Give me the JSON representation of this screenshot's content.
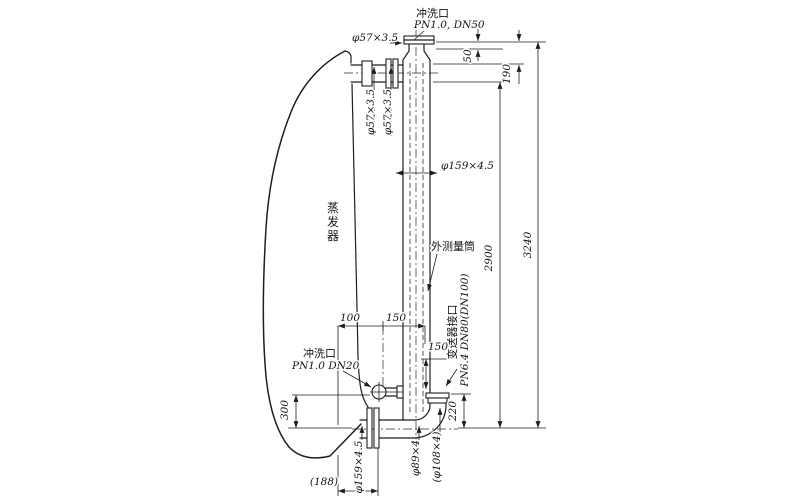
{
  "meta": {
    "background_color": "#ffffff",
    "ink_color": "#1e1e1e",
    "drawing_subject": "evaporator external level gauge piping"
  },
  "labels": [
    {
      "name": "top-flush-port-name",
      "text": "冲洗口",
      "x": 416,
      "y": 17,
      "cls": "cn",
      "anchor": "start"
    },
    {
      "name": "top-flush-port-spec",
      "text": "PN1.0, DN50",
      "x": 414,
      "y": 28,
      "cls": "spec",
      "anchor": "start"
    },
    {
      "name": "top-pipe-spec",
      "text": "φ57×3.5",
      "x": 352,
      "y": 41,
      "cls": "spec",
      "anchor": "start"
    },
    {
      "name": "riser-pipe-spec-1",
      "text": "φ57×3.5",
      "x": 374,
      "y": 112,
      "cls": "spec",
      "anchor": "middle",
      "rot": -90
    },
    {
      "name": "riser-pipe-spec-2",
      "text": "φ57×3.5",
      "x": 391,
      "y": 112,
      "cls": "spec",
      "anchor": "middle",
      "rot": -90
    },
    {
      "name": "cylinder-pipe-spec",
      "text": "φ159×4.5",
      "x": 441,
      "y": 169,
      "cls": "spec",
      "anchor": "start"
    },
    {
      "name": "evaporator-label",
      "text": "蒸发器",
      "x": 333,
      "y": 212,
      "cls": "cnv",
      "anchor": "middle"
    },
    {
      "name": "outer-cylinder-label",
      "text": "外测量筒",
      "x": 431,
      "y": 250,
      "cls": "cn",
      "anchor": "start"
    },
    {
      "name": "transmitter-port-name",
      "text": "变送器接口",
      "x": 456,
      "y": 332,
      "cls": "cn",
      "anchor": "middle",
      "rot": -90
    },
    {
      "name": "transmitter-port-spec",
      "text": "PN6.4 DN80(DN100)",
      "x": 468,
      "y": 330,
      "cls": "spec",
      "anchor": "middle",
      "rot": -90
    },
    {
      "name": "bottom-flush-port-name",
      "text": "冲洗口",
      "x": 303,
      "y": 357,
      "cls": "cn",
      "anchor": "start"
    },
    {
      "name": "bottom-flush-port-spec",
      "text": "PN1.0 DN20",
      "x": 292,
      "y": 369,
      "cls": "spec",
      "anchor": "start"
    },
    {
      "name": "dim-50",
      "text": "50",
      "x": 471,
      "y": 56,
      "cls": "dim",
      "anchor": "middle",
      "rot": -90
    },
    {
      "name": "dim-190",
      "text": "190",
      "x": 510,
      "y": 74,
      "cls": "dim",
      "anchor": "middle",
      "rot": -90
    },
    {
      "name": "dim-2900",
      "text": "2900",
      "x": 492,
      "y": 258,
      "cls": "dim",
      "anchor": "middle",
      "rot": -90
    },
    {
      "name": "dim-3240",
      "text": "3240",
      "x": 531,
      "y": 245,
      "cls": "dim",
      "anchor": "middle",
      "rot": -90
    },
    {
      "name": "dim-100",
      "text": "100",
      "x": 350,
      "y": 321,
      "cls": "dim",
      "anchor": "middle"
    },
    {
      "name": "dim-150-horizontal",
      "text": "150",
      "x": 396,
      "y": 321,
      "cls": "dim",
      "anchor": "middle"
    },
    {
      "name": "dim-150-branch",
      "text": "150",
      "x": 438,
      "y": 350,
      "cls": "dim",
      "anchor": "middle"
    },
    {
      "name": "dim-220",
      "text": "220",
      "x": 456,
      "y": 411,
      "cls": "dim",
      "anchor": "middle",
      "rot": -90
    },
    {
      "name": "dim-300",
      "text": "300",
      "x": 288,
      "y": 410,
      "cls": "dim",
      "anchor": "middle",
      "rot": -90
    },
    {
      "name": "dim-188",
      "text": "(188)",
      "x": 324,
      "y": 485,
      "cls": "dim",
      "anchor": "middle"
    },
    {
      "name": "bottom-pipe-spec",
      "text": "φ159×4.5",
      "x": 362,
      "y": 467,
      "cls": "spec",
      "anchor": "middle",
      "rot": -90
    },
    {
      "name": "elbow-pipe-spec",
      "text": "φ89×4",
      "x": 419,
      "y": 458,
      "cls": "spec",
      "anchor": "middle",
      "rot": -90
    },
    {
      "name": "elbow-pipe-spec-alt",
      "text": "(φ108×4)",
      "x": 440,
      "y": 457,
      "cls": "spec",
      "anchor": "middle",
      "rot": -90
    }
  ]
}
